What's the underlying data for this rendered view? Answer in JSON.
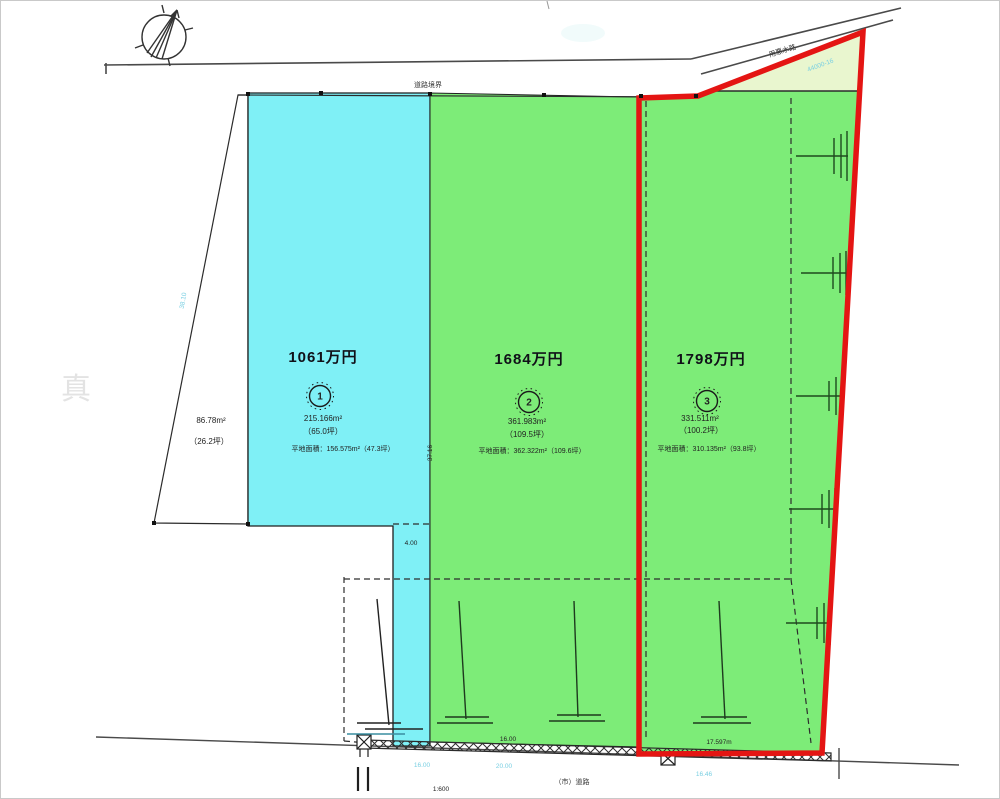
{
  "compass": {
    "icon": "north-arrow"
  },
  "watermark": {
    "text": "真"
  },
  "roads": {
    "top_label": "道路境界",
    "diagonal_label": "用悪水路",
    "bottom_label": "（市）道路"
  },
  "marks": {
    "scale_note": "1:600"
  },
  "parcels": {
    "west": {
      "area": "86.78m²",
      "tsubo": "（26.2坪）",
      "fill": "#ffffff"
    },
    "lot1": {
      "price": "1061万円",
      "number": "1",
      "area": "215.166m²",
      "tsubo": "（65.0坪）",
      "flat": "平地面積：156.575m²（47.3坪）",
      "fill": "#7ff0f6"
    },
    "lot2": {
      "price": "1684万円",
      "number": "2",
      "area": "361.983m²",
      "tsubo": "（109.5坪）",
      "flat": "平地面積：362.322m²（109.6坪）",
      "fill": "#7dec78"
    },
    "lot3": {
      "price": "1798万円",
      "number": "3",
      "area": "331.511m²",
      "tsubo": "（100.2坪）",
      "flat": "平地面積：310.135m²（93.8坪）",
      "fill": "#7dec78",
      "highlight": "#e41513"
    },
    "corner_wedge": {
      "fill": "#e9f6cf"
    }
  },
  "dimensions": {
    "pole_width": "4.00",
    "boundary_length": "37.16",
    "lot2_frontage": "16.00",
    "lot3_frontage": "17.597m",
    "road_dim1": "16.00",
    "road_dim2": "20.00",
    "road_dim3": "16.46",
    "west_edge": "38.10",
    "corner_note": "44000-16"
  }
}
